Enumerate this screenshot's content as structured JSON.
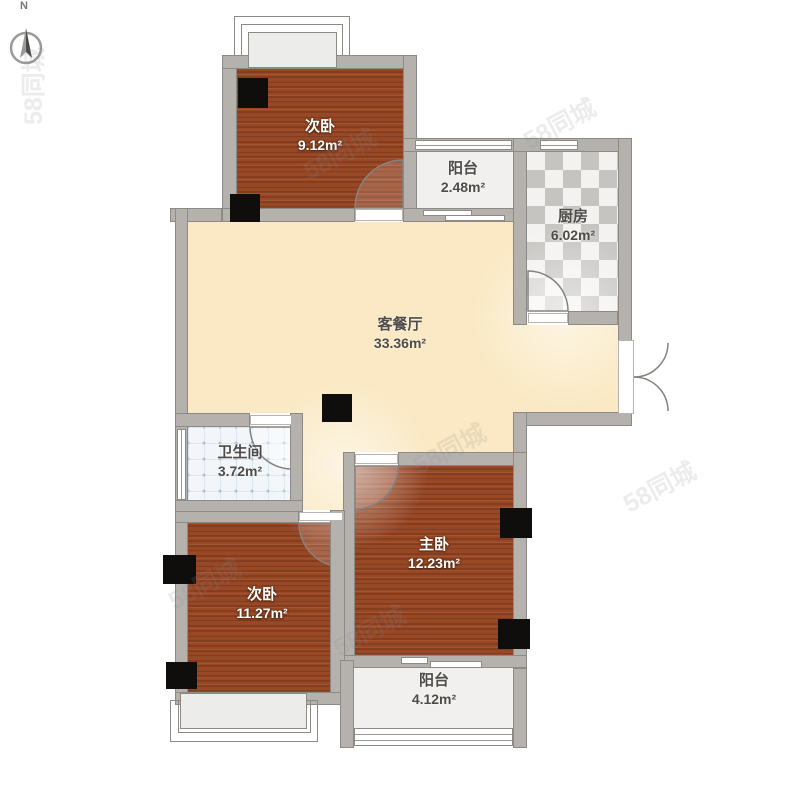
{
  "compass": {
    "label": "N"
  },
  "watermark": {
    "text": "58同城"
  },
  "rooms": [
    {
      "name": "次卧",
      "area": "9.12m²"
    },
    {
      "name": "阳台",
      "area": "2.48m²"
    },
    {
      "name": "厨房",
      "area": "6.02m²"
    },
    {
      "name": "客餐厅",
      "area": "33.36m²"
    },
    {
      "name": "卫生间",
      "area": "3.72m²"
    },
    {
      "name": "次卧",
      "area": "11.27m²"
    },
    {
      "name": "主卧",
      "area": "12.23m²"
    },
    {
      "name": "阳台",
      "area": "4.12m²"
    }
  ],
  "palette": {
    "bedroom_floor": "#9a4724",
    "living_floor": "#fae9c4",
    "balcony_floor": "#f1f0ee",
    "kitchen_tile_dark": "#c6c4c1",
    "bath_tile": "#f2f6f9",
    "wall": "#b5b2ae",
    "column": "#0f0e0d"
  }
}
